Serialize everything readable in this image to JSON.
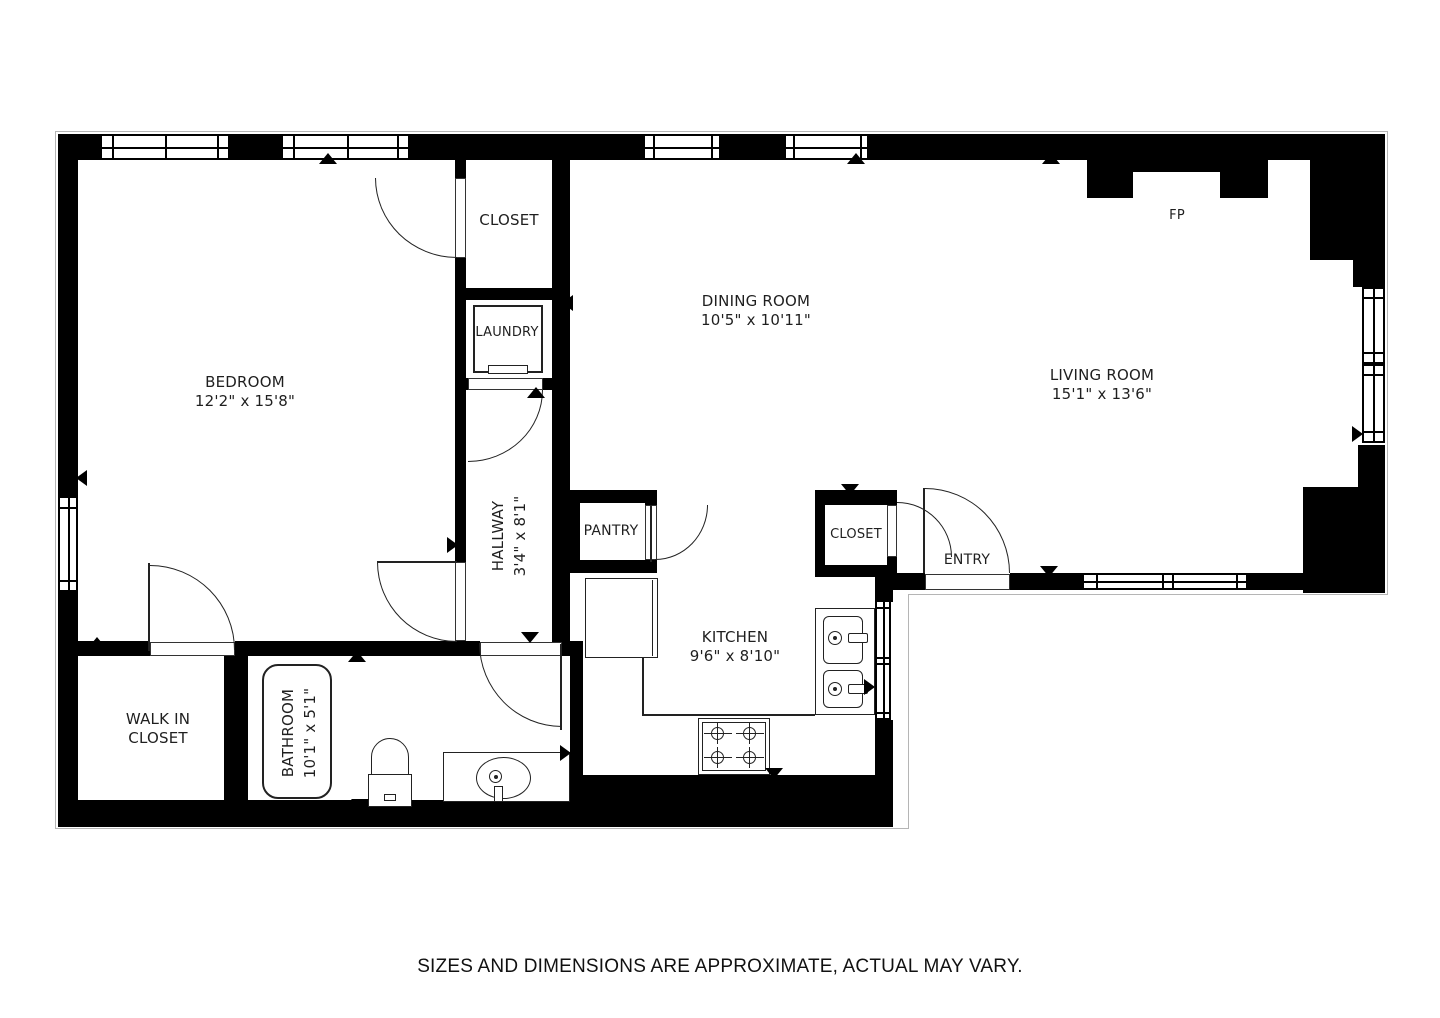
{
  "footer": {
    "text": "SIZES AND DIMENSIONS ARE APPROXIMATE, ACTUAL MAY VARY."
  },
  "rooms": {
    "bedroom": {
      "name": "BEDROOM",
      "dims": "12'2\" x 15'8\""
    },
    "dining_room": {
      "name": "DINING ROOM",
      "dims": "10'5\" x 10'11\""
    },
    "living_room": {
      "name": "LIVING ROOM",
      "dims": "15'1\" x 13'6\""
    },
    "kitchen": {
      "name": "KITCHEN",
      "dims": "9'6\" x 8'10\""
    },
    "hallway": {
      "name": "HALLWAY",
      "dims": "3'4\" x 8'1\""
    },
    "bathroom": {
      "name": "BATHROOM",
      "dims": "10'1\" x 5'1\""
    },
    "walk_in_closet": {
      "line1": "WALK IN",
      "line2": "CLOSET"
    }
  },
  "labels": {
    "closet_top": "CLOSET",
    "laundry": "LAUNDRY",
    "pantry": "PANTRY",
    "entry_closet": "CLOSET",
    "entry": "ENTRY",
    "fireplace": "FP"
  },
  "colors": {
    "wall": "#000000",
    "background": "#ffffff",
    "line": "#222222",
    "text": "#1f1f1f",
    "outline": "#b5b5b5"
  }
}
